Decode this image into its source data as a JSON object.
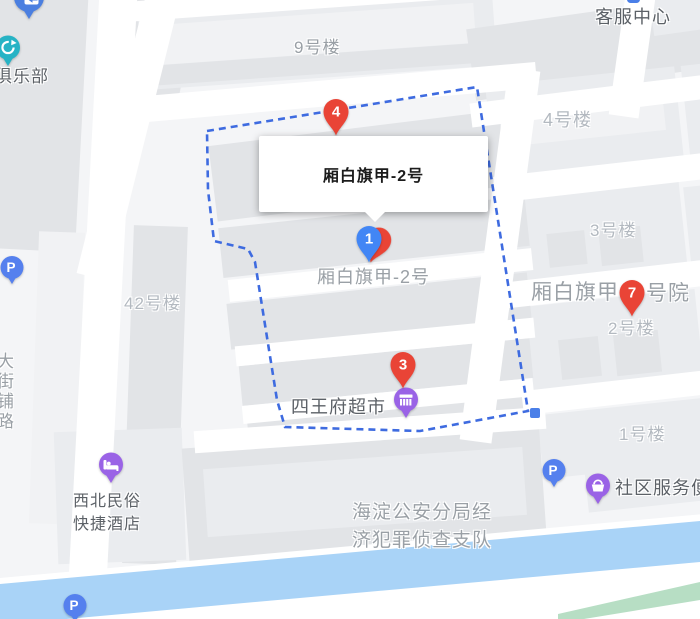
{
  "infobox": {
    "title": "厢白旗甲-2号"
  },
  "colors": {
    "marker_red": "#e94436",
    "marker_blue": "#4286f5",
    "poi_purple": "#9a63e6",
    "parking_blue": "#5580ee",
    "club_teal": "#27b3c5",
    "transit_blue": "#4b7fe0",
    "boundary_blue": "#3e6be0",
    "river_blue": "#a9d3f7",
    "greenway_green": "#b7dec4",
    "label_dark": "#5c6167",
    "label_mid": "#9aa0a6",
    "label_light": "#b3b9c0"
  },
  "labels": [
    {
      "text": "客服中心",
      "x": 595,
      "y": 3,
      "size": 18,
      "color": "dark"
    },
    {
      "text": "俱乐部",
      "x": -5,
      "y": 62,
      "size": 17,
      "color": "dark"
    },
    {
      "text": "9号楼",
      "x": 294,
      "y": 33,
      "size": 17,
      "color": "mid"
    },
    {
      "text": "4号楼",
      "x": 543,
      "y": 106,
      "size": 18,
      "color": "light"
    },
    {
      "text": "3号楼",
      "x": 590,
      "y": 216,
      "size": 17,
      "color": "light"
    },
    {
      "text": "厢白旗甲",
      "x": 531,
      "y": 276,
      "size": 21,
      "color": "mid"
    },
    {
      "text": "号院",
      "x": 646,
      "y": 277,
      "size": 21,
      "color": "mid"
    },
    {
      "text": "2号楼",
      "x": 608,
      "y": 314,
      "size": 17,
      "color": "light"
    },
    {
      "text": "42号楼",
      "x": 124,
      "y": 289,
      "size": 17,
      "color": "light"
    },
    {
      "text": "厢白旗甲-2号",
      "x": 317,
      "y": 263,
      "size": 18,
      "color": "mid"
    },
    {
      "text": "四王府超市",
      "x": 291,
      "y": 393,
      "size": 18,
      "color": "dark"
    },
    {
      "text": "1号楼",
      "x": 619,
      "y": 420,
      "size": 17,
      "color": "light"
    },
    {
      "text": "社区服务便",
      "x": 615,
      "y": 474,
      "size": 18,
      "color": "dark"
    },
    {
      "text": "西北民俗",
      "x": 73,
      "y": 487,
      "size": 16,
      "color": "dark"
    },
    {
      "text": "快捷酒店",
      "x": 73,
      "y": 510,
      "size": 16,
      "color": "dark"
    },
    {
      "text": "海淀公安分局经",
      "x": 352,
      "y": 497,
      "size": 19,
      "color": "mid"
    },
    {
      "text": "济犯罪侦查支队",
      "x": 352,
      "y": 525,
      "size": 19,
      "color": "mid"
    },
    {
      "text": "大街铺路",
      "x": -9,
      "y": 352,
      "size": 17,
      "color": "mid",
      "vertical": true
    }
  ],
  "markers": [
    {
      "label": "4",
      "color": "#e94436",
      "tip_x": 336,
      "tip_y": 137
    },
    {
      "label": "1",
      "color": "#4286f5",
      "tip_x": 369,
      "tip_y": 264,
      "behind_color": "#e94436"
    },
    {
      "label": "3",
      "color": "#e94436",
      "tip_x": 403,
      "tip_y": 390
    },
    {
      "label": "7",
      "color": "#e94436",
      "tip_x": 632,
      "tip_y": 318
    }
  ],
  "pois": [
    {
      "icon": "store",
      "cx": 406,
      "cy": 399,
      "color": "#9a63e6"
    },
    {
      "icon": "bed",
      "cx": 111,
      "cy": 464,
      "color": "#9a63e6"
    },
    {
      "icon": "basket",
      "cx": 598,
      "cy": 485,
      "color": "#9a63e6"
    },
    {
      "icon": "parking",
      "cx": 12,
      "cy": 267,
      "color": "#5580ee"
    },
    {
      "icon": "parking",
      "cx": 75,
      "cy": 605,
      "color": "#5580ee"
    },
    {
      "icon": "parking",
      "cx": 554,
      "cy": 470,
      "color": "#5580ee"
    },
    {
      "icon": "club",
      "cx": 8,
      "cy": 47,
      "color": "#27b3c5"
    },
    {
      "icon": "transit",
      "cx": 29,
      "cy": -3,
      "color": "#4b7fe0"
    }
  ],
  "boundary_points": "207,131 477,87 528,411 420,431 285,427 277,400 255,262 248,249 214,241 208,190",
  "river_points": "0,584 700,521 700,564 0,629",
  "under_river_points": "0,625 700,562 700,619 0,619",
  "green_points": "558,614 700,582 700,600 584,619 558,619"
}
